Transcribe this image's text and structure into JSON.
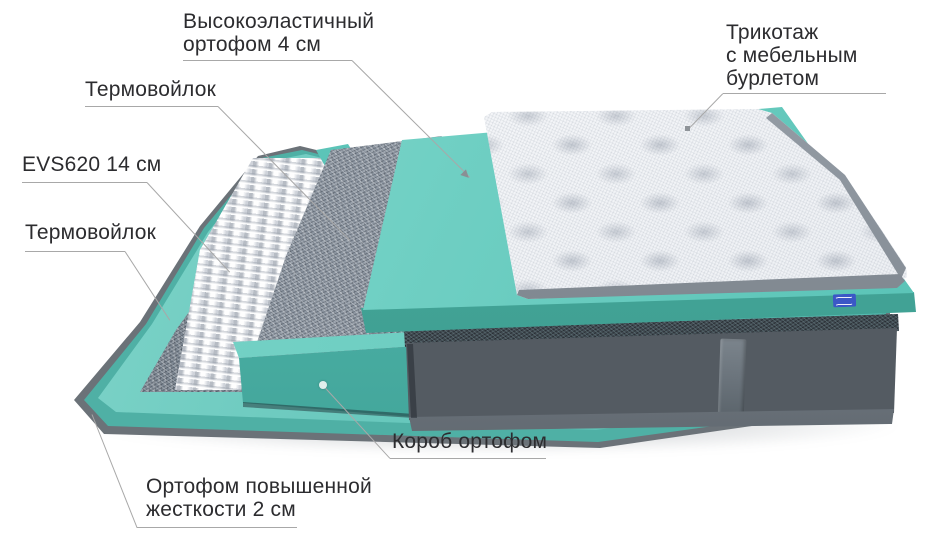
{
  "diagram": {
    "type": "mattress-layer-structure",
    "background": "#ffffff",
    "labels": [
      {
        "id": "highelastic-orthofoam",
        "lines": [
          "Высокоэластичный",
          "ортофом 4 см"
        ],
        "marker": "arrow"
      },
      {
        "id": "thermofelt-upper",
        "lines": [
          "Термовойлок"
        ],
        "marker": "none"
      },
      {
        "id": "springs-evs620",
        "lines": [
          "EVS620 14 см"
        ],
        "marker": "none"
      },
      {
        "id": "thermofelt-lower",
        "lines": [
          "Термовойлок"
        ],
        "marker": "none"
      },
      {
        "id": "knit-cover",
        "lines": [
          "Трикотаж",
          "с мебельным",
          "бурлетом"
        ],
        "marker": "square"
      },
      {
        "id": "orthofoam-box",
        "lines": [
          "Короб ортофом"
        ],
        "marker": "dot"
      },
      {
        "id": "base-orthofoam",
        "lines": [
          "Ортофом повышенной",
          "жесткости 2 см"
        ],
        "marker": "none"
      }
    ],
    "layers": [
      {
        "name": "knit-cover-top",
        "color": "#f2f4f7"
      },
      {
        "name": "highelastic-orthofoam-slab",
        "color": "#6fcfc3"
      },
      {
        "name": "thermofelt-upper-sheet",
        "color": "#8d96a1"
      },
      {
        "name": "pocket-springs-evs620",
        "color": "#edeff2"
      },
      {
        "name": "orthofoam-box-frame",
        "color": "#4fb5aa"
      },
      {
        "name": "thermofelt-lower-sheet",
        "color": "#7e8893"
      },
      {
        "name": "base-orthofoam-sheet",
        "color": "#64c5ba"
      },
      {
        "name": "mattress-body-velvet",
        "color": "#545b62"
      }
    ],
    "accents": {
      "brand_tag_color": "#3b57c6",
      "leader_line_color": "#a8a8a8",
      "text_color": "#2c2c2f"
    }
  }
}
